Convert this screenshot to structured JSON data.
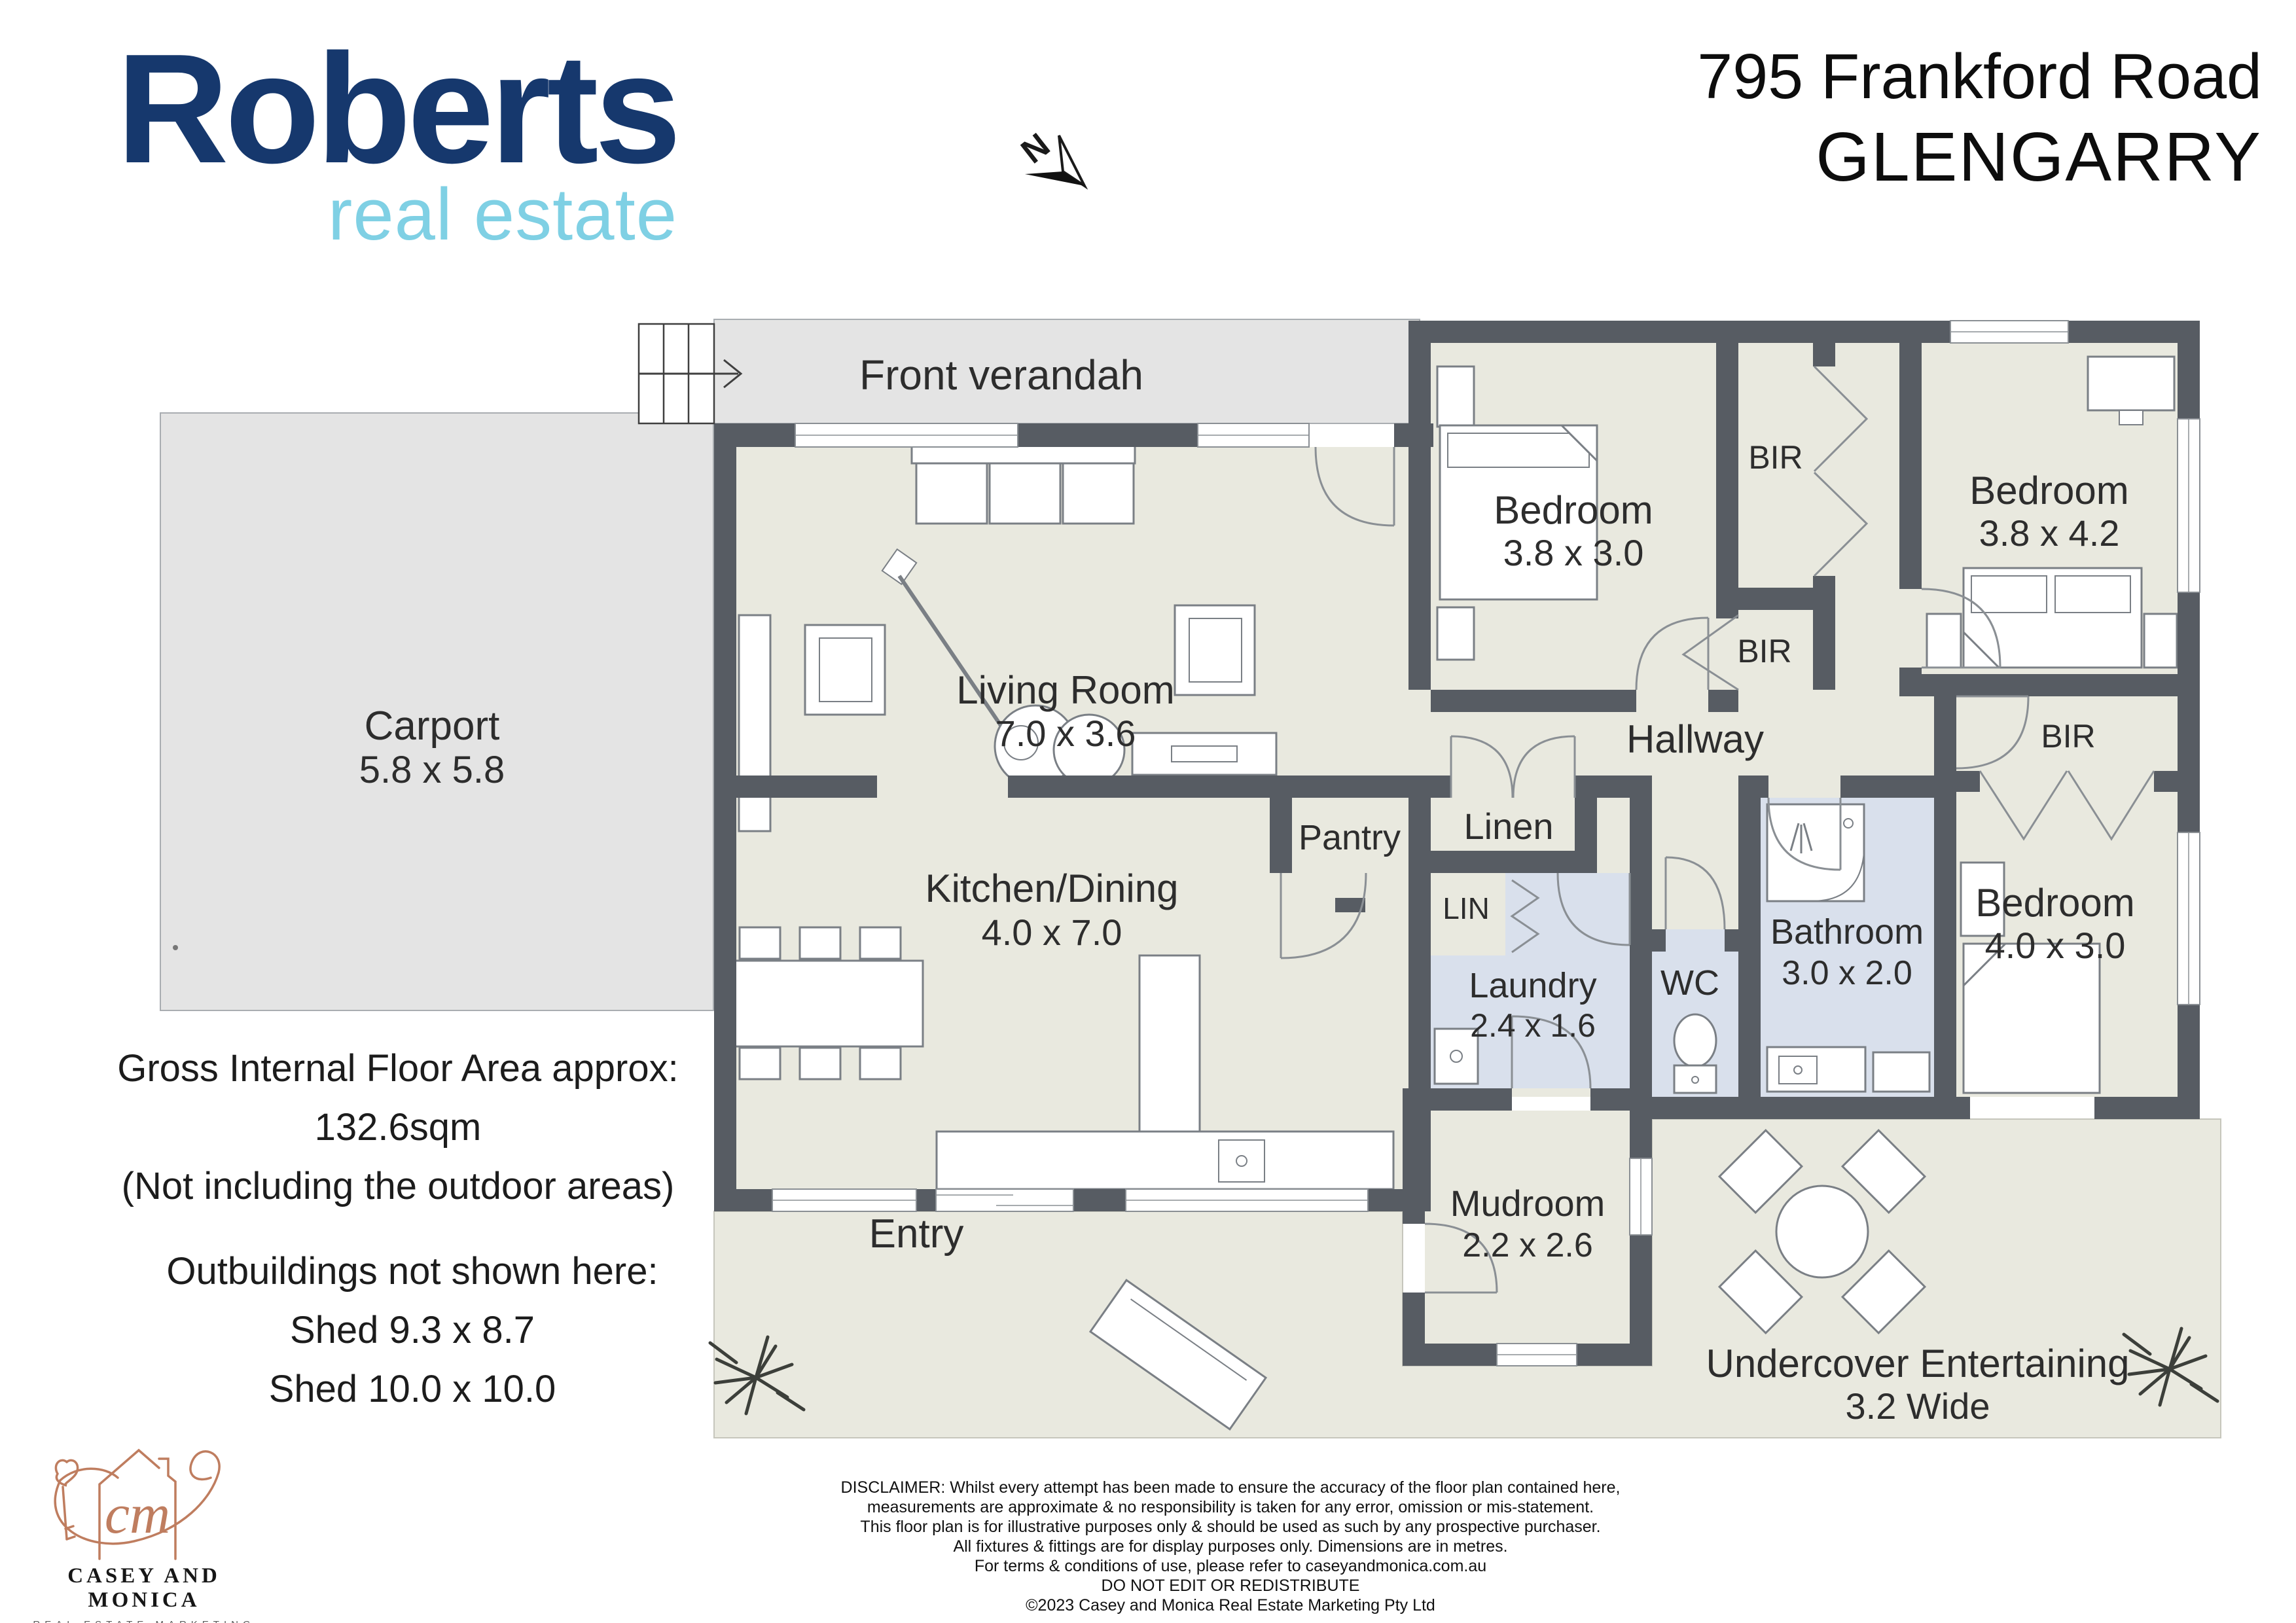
{
  "header": {
    "agency_line1": "Roberts",
    "agency_line2": "real estate",
    "address_line1": "795 Frankford Road",
    "address_line2": "GLENGARRY",
    "north_label": "N"
  },
  "rooms": {
    "front_verandah": {
      "name": "Front verandah"
    },
    "carport": {
      "name": "Carport",
      "dims": "5.8 x 5.8"
    },
    "living": {
      "name": "Living Room",
      "dims": "7.0 x 3.6"
    },
    "kitchen": {
      "name": "Kitchen/Dining",
      "dims": "4.0 x 7.0"
    },
    "bedroom1": {
      "name": "Bedroom",
      "dims": "3.8 x 3.0"
    },
    "bedroom2": {
      "name": "Bedroom",
      "dims": "3.8 x 4.2"
    },
    "bedroom3": {
      "name": "Bedroom",
      "dims": "4.0 x 3.0"
    },
    "bir": "BIR",
    "hallway": {
      "name": "Hallway"
    },
    "linen": {
      "name": "Linen"
    },
    "pantry": {
      "name": "Pantry"
    },
    "lin": {
      "name": "LIN"
    },
    "laundry": {
      "name": "Laundry",
      "dims": "2.4 x 1.6"
    },
    "wc": {
      "name": "WC"
    },
    "bathroom": {
      "name": "Bathroom",
      "dims": "3.0 x 2.0"
    },
    "mudroom": {
      "name": "Mudroom",
      "dims": "2.2 x 2.6"
    },
    "entry": {
      "name": "Entry"
    },
    "undercover": {
      "name": "Undercover Entertaining",
      "dims": "3.2 Wide"
    }
  },
  "floor_area": {
    "line1": "Gross Internal Floor Area approx:",
    "line2": "132.6sqm",
    "line3": "(Not including the outdoor areas)"
  },
  "outbuildings": {
    "line1": "Outbuildings not shown here:",
    "line2": "Shed 9.3 x 8.7",
    "line3": "Shed 10.0 x 10.0"
  },
  "disclaimer": {
    "lines": [
      "DISCLAIMER: Whilst every attempt has been made to ensure the accuracy of the floor plan contained here,",
      "measurements are approximate & no responsibility is taken for any error, omission or mis-statement.",
      "This floor plan is for illustrative purposes only & should be used as such by any prospective purchaser.",
      "All fixtures & fittings are for display purposes only. Dimensions are in metres.",
      "For terms & conditions of use, please refer to caseyandmonica.com.au",
      "DO NOT EDIT OR REDISTRIBUTE",
      "©2023 Casey and Monica Real Estate Marketing Pty Ltd"
    ]
  },
  "footer_logo": {
    "name": "CASEY AND MONICA",
    "tagline": "REAL ESTATE MARKETING",
    "monogram": "cm"
  },
  "colors": {
    "roberts_navy": "#16386d",
    "roberts_blue": "#7fd0e4",
    "wall": "#575c63",
    "interior_floor": "#e9e9df",
    "wet_floor": "#d9e0ec",
    "outdoor": "#e4e4e4",
    "logo_copper": "#bf7d5f"
  }
}
